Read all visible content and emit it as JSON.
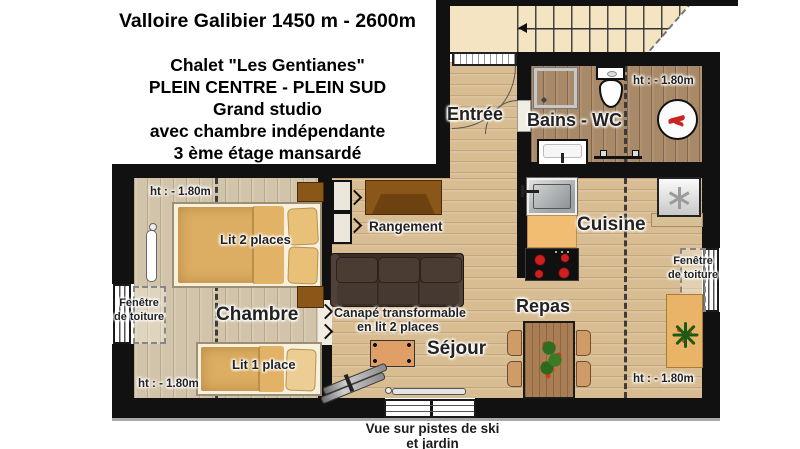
{
  "title_block": {
    "lines": [
      "Valloire Galibier 1450 m - 2600m",
      "Chalet \"Les Gentianes\"",
      "PLEIN CENTRE - PLEIN SUD",
      "Grand studio",
      "avec chambre indépendante",
      "3 ème étage  mansardé"
    ]
  },
  "rooms": {
    "entree": "Entrée",
    "bains": "Bains - WC",
    "cuisine": "Cuisine",
    "rangement": "Rangement",
    "sejour": "Séjour",
    "repas": "Repas",
    "chambre": "Chambre"
  },
  "annotations": {
    "height_note": "ht : - 1.80m",
    "roof_window_line1": "Fenêtre",
    "roof_window_line2": "de toiture",
    "bed_double": "Lit 2 places",
    "bed_single": "Lit 1 place",
    "sofa_line1": "Canapé transformable",
    "sofa_line2": "en lit 2 places",
    "view_line1": "Vue sur pistes de ski",
    "view_line2": "et jardin"
  },
  "icons": {
    "stairs_arrow": "left-arrow",
    "fridge": "snowflake",
    "plant": "green-starburst",
    "flowers": "bouquet",
    "washer_logo": "red-swirl",
    "door_chevron": "right-chevron",
    "skis": "pair-of-skis"
  },
  "colors": {
    "wall": "#111111",
    "floor_living": "#d8bc92",
    "floor_bedroom": "#d2c4aa",
    "floor_bath": "#a88a68",
    "stairs": "#f4e4c1",
    "mattress": "#dcae63",
    "wood_furniture": "#8a5718",
    "sofa": "#3a2e27",
    "counter": "#f0bd72",
    "burner": "#cf1f1f",
    "dining_table": "#a97e54",
    "plant": "#1d5a16",
    "chair": "#cf9c67"
  }
}
